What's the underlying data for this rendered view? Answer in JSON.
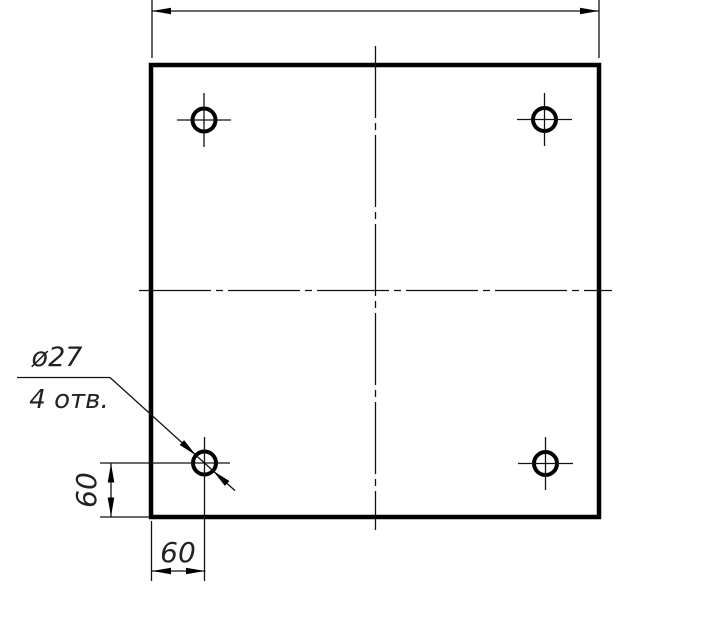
{
  "callout": {
    "diameter": "ø27",
    "holes": "4 отв."
  },
  "dimensions": {
    "hole_offset_vertical": "60",
    "hole_offset_horizontal": "60"
  },
  "colors": {
    "ink": "#000000",
    "paper": "#ffffff"
  }
}
